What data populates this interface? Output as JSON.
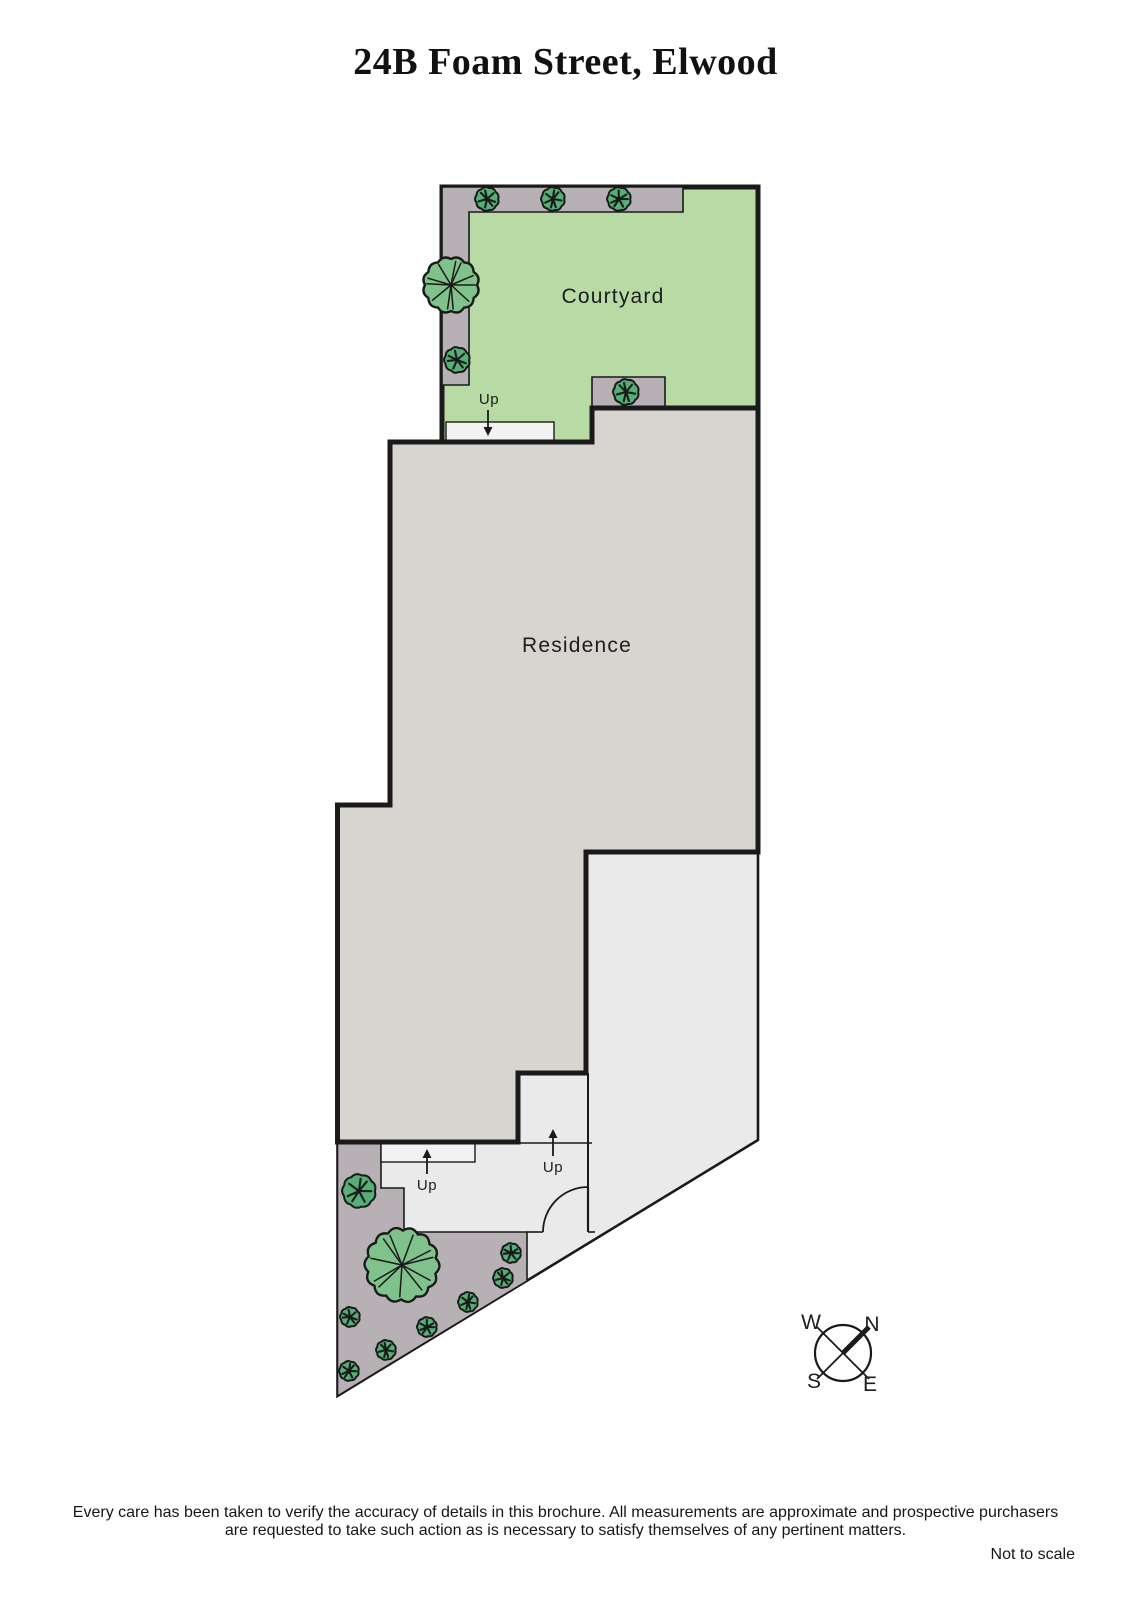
{
  "title": "24B Foam Street, Elwood",
  "footer": {
    "disclaimer_line1": "Every care has been taken to verify the accuracy of details in this brochure.  All measurements are approximate and prospective purchasers",
    "disclaimer_line2": "are requested to take such action as is necessary to satisfy themselves of any pertinent matters.",
    "scale_note": "Not to scale"
  },
  "colors": {
    "wall": "#1a1a1a",
    "site_fill": "#eaeaea",
    "courtyard_fill": "#b8dba6",
    "residence_fill": "#d8d4d0",
    "bed_fill": "#b7b0b4",
    "stair_fill": "#f2f2f2",
    "tree_fill": "#7fc28b",
    "bush_fill": "#54b077",
    "label_color": "#1d1d1d"
  },
  "plan": {
    "site_outline": "442,187 758,187 758,1140 337.5,1396 337.5,805 390,805 390,442 442,442",
    "courtyard": {
      "points": "442,187 758,187 758,408 592,408 592,442 442,442",
      "label": "Courtyard",
      "lx": 613,
      "ly": 296
    },
    "residence": {
      "points": "390,442 592,442 592,408 758,408 758,852 586,852 586,1073 518,1073 518,1142 337.5,1142 337.5,805 390,805",
      "label": "Residence",
      "lx": 577,
      "ly": 645
    },
    "beds": [
      {
        "name": "courtyard-bed-top-left",
        "points": "442,187 683,187 683,212 469,212 469,385 442,385"
      },
      {
        "name": "courtyard-bed-right",
        "points": "592,377 665,377 665,408 592,408"
      },
      {
        "name": "front-garden-bed",
        "points": "337.5,1143 381,1143 381,1188 404,1188 404,1232 527,1232 527,1281 337.5,1396"
      }
    ],
    "stairs": [
      {
        "name": "courtyard-steps",
        "x": 446,
        "y": 422,
        "w": 108,
        "h": 20
      },
      {
        "name": "walkway-steps",
        "x": 381,
        "y": 1143,
        "w": 94,
        "h": 19
      }
    ],
    "lines": [
      {
        "name": "stairwell-step-line",
        "x1": 518,
        "y1": 1143,
        "x2": 592,
        "y2": 1143,
        "w": 1.6
      },
      {
        "name": "stairwell-divider",
        "x1": 588,
        "y1": 1073,
        "x2": 588,
        "y2": 1232,
        "w": 2
      },
      {
        "name": "door-wall-segment",
        "x1": 527,
        "y1": 1232,
        "x2": 543,
        "y2": 1232,
        "w": 1.6
      },
      {
        "name": "door-threshold-segment",
        "x1": 588,
        "y1": 1232,
        "x2": 595,
        "y2": 1232,
        "w": 1.6
      }
    ],
    "door": {
      "arc": "M588,1187 A45,45 0 0 0 543,1232",
      "leaf": {
        "x1": 588,
        "y1": 1187,
        "x2": 588,
        "y2": 1232
      }
    },
    "trees": [
      {
        "type": "tree",
        "x": 451,
        "y": 285,
        "r": 28
      },
      {
        "type": "tree",
        "x": 402,
        "y": 1265,
        "r": 37
      },
      {
        "type": "bush",
        "x": 487,
        "y": 199,
        "r": 12
      },
      {
        "type": "bush",
        "x": 553,
        "y": 199,
        "r": 12
      },
      {
        "type": "bush",
        "x": 619,
        "y": 199,
        "r": 12
      },
      {
        "type": "bush",
        "x": 457,
        "y": 360,
        "r": 13
      },
      {
        "type": "bush",
        "x": 626,
        "y": 392,
        "r": 13
      },
      {
        "type": "bush",
        "x": 359,
        "y": 1191,
        "r": 17
      },
      {
        "type": "bush",
        "x": 511,
        "y": 1253,
        "r": 10
      },
      {
        "type": "bush",
        "x": 503,
        "y": 1278,
        "r": 10
      },
      {
        "type": "bush",
        "x": 468,
        "y": 1302,
        "r": 10
      },
      {
        "type": "bush",
        "x": 427,
        "y": 1327,
        "r": 10
      },
      {
        "type": "bush",
        "x": 350,
        "y": 1317,
        "r": 10
      },
      {
        "type": "bush",
        "x": 386,
        "y": 1350,
        "r": 10
      },
      {
        "type": "bush",
        "x": 349,
        "y": 1371,
        "r": 10
      }
    ],
    "up_markers": [
      {
        "label": "Up",
        "tx": 489,
        "ty": 404,
        "ax": 488,
        "ay1": 410,
        "ay2": 436,
        "dir": "down"
      },
      {
        "label": "Up",
        "tx": 427,
        "ty": 1190,
        "ax": 427,
        "ay1": 1174,
        "ay2": 1149,
        "dir": "up"
      },
      {
        "label": "Up",
        "tx": 553,
        "ty": 1172,
        "ax": 553,
        "ay1": 1156,
        "ay2": 1129,
        "dir": "up"
      }
    ],
    "compass": {
      "cx": 843,
      "cy": 1353,
      "r": 28,
      "labels": [
        {
          "t": "W",
          "x": 811,
          "y": 1322
        },
        {
          "t": "N",
          "x": 872,
          "y": 1324
        },
        {
          "t": "S",
          "x": 814,
          "y": 1381
        },
        {
          "t": "E",
          "x": 870,
          "y": 1384
        }
      ]
    }
  }
}
